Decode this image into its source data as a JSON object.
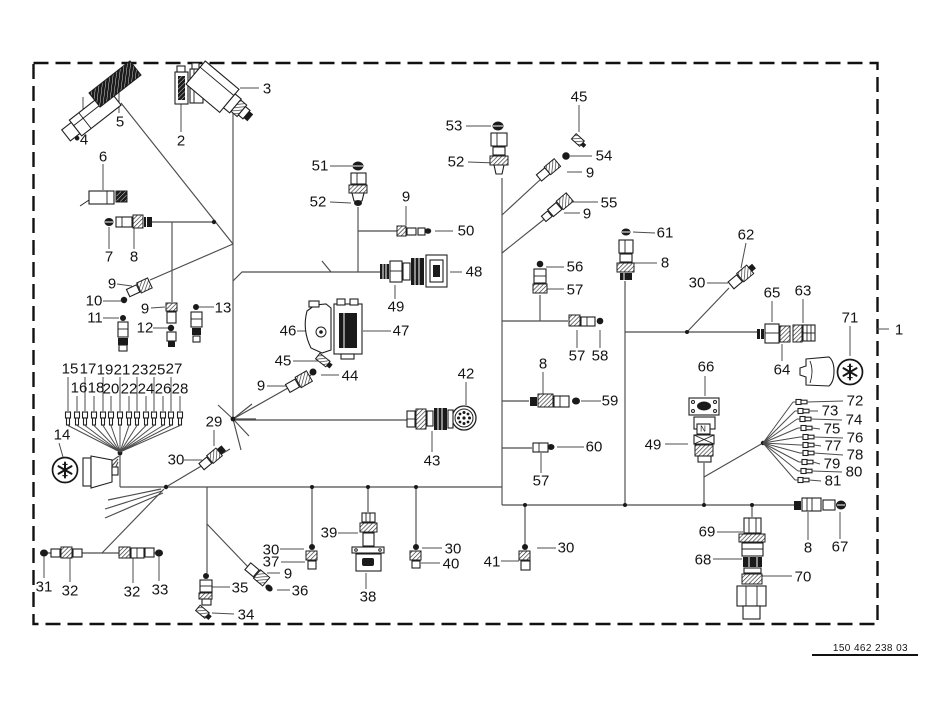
{
  "figure": {
    "drawing_number": "150 462 238 03",
    "frame_reference_label": "1"
  },
  "callouts": [
    {
      "t": "4",
      "x": 84,
      "y": 140
    },
    {
      "t": "5",
      "x": 120,
      "y": 122
    },
    {
      "t": "2",
      "x": 181,
      "y": 141
    },
    {
      "t": "3",
      "x": 267,
      "y": 89
    },
    {
      "t": "6",
      "x": 103,
      "y": 157
    },
    {
      "t": "7",
      "x": 109,
      "y": 257
    },
    {
      "t": "8",
      "x": 134,
      "y": 257
    },
    {
      "t": "9",
      "x": 112,
      "y": 284
    },
    {
      "t": "10",
      "x": 94,
      "y": 301
    },
    {
      "t": "11",
      "x": 95,
      "y": 318
    },
    {
      "t": "9",
      "x": 145,
      "y": 309
    },
    {
      "t": "12",
      "x": 145,
      "y": 328
    },
    {
      "t": "13",
      "x": 223,
      "y": 308
    },
    {
      "t": "51",
      "x": 320,
      "y": 166
    },
    {
      "t": "52",
      "x": 318,
      "y": 202
    },
    {
      "t": "9",
      "x": 406,
      "y": 197
    },
    {
      "t": "50",
      "x": 466,
      "y": 231
    },
    {
      "t": "53",
      "x": 454,
      "y": 126
    },
    {
      "t": "52",
      "x": 456,
      "y": 162
    },
    {
      "t": "45",
      "x": 579,
      "y": 97
    },
    {
      "t": "54",
      "x": 604,
      "y": 156
    },
    {
      "t": "9",
      "x": 590,
      "y": 173
    },
    {
      "t": "55",
      "x": 609,
      "y": 203
    },
    {
      "t": "9",
      "x": 587,
      "y": 214
    },
    {
      "t": "61",
      "x": 665,
      "y": 233
    },
    {
      "t": "8",
      "x": 665,
      "y": 263
    },
    {
      "t": "62",
      "x": 746,
      "y": 235
    },
    {
      "t": "30",
      "x": 697,
      "y": 283
    },
    {
      "t": "56",
      "x": 575,
      "y": 267
    },
    {
      "t": "57",
      "x": 575,
      "y": 290
    },
    {
      "t": "65",
      "x": 772,
      "y": 293
    },
    {
      "t": "63",
      "x": 803,
      "y": 291
    },
    {
      "t": "71",
      "x": 850,
      "y": 318
    },
    {
      "t": "64",
      "x": 782,
      "y": 370
    },
    {
      "t": "48",
      "x": 474,
      "y": 272
    },
    {
      "t": "49",
      "x": 396,
      "y": 307
    },
    {
      "t": "46",
      "x": 288,
      "y": 331
    },
    {
      "t": "47",
      "x": 401,
      "y": 331
    },
    {
      "t": "45",
      "x": 283,
      "y": 361
    },
    {
      "t": "44",
      "x": 350,
      "y": 376
    },
    {
      "t": "9",
      "x": 261,
      "y": 386
    },
    {
      "t": "42",
      "x": 466,
      "y": 374
    },
    {
      "t": "43",
      "x": 432,
      "y": 461
    },
    {
      "t": "57",
      "x": 577,
      "y": 356
    },
    {
      "t": "58",
      "x": 600,
      "y": 356
    },
    {
      "t": "8",
      "x": 543,
      "y": 364
    },
    {
      "t": "59",
      "x": 610,
      "y": 401
    },
    {
      "t": "60",
      "x": 594,
      "y": 447
    },
    {
      "t": "57",
      "x": 541,
      "y": 481
    },
    {
      "t": "66",
      "x": 706,
      "y": 367
    },
    {
      "t": "49",
      "x": 653,
      "y": 445
    },
    {
      "t": "72",
      "x": 855,
      "y": 401
    },
    {
      "t": "73",
      "x": 830,
      "y": 411
    },
    {
      "t": "74",
      "x": 854,
      "y": 420
    },
    {
      "t": "75",
      "x": 832,
      "y": 429
    },
    {
      "t": "76",
      "x": 855,
      "y": 438
    },
    {
      "t": "77",
      "x": 833,
      "y": 446
    },
    {
      "t": "78",
      "x": 855,
      "y": 455
    },
    {
      "t": "79",
      "x": 832,
      "y": 464
    },
    {
      "t": "80",
      "x": 854,
      "y": 472
    },
    {
      "t": "81",
      "x": 833,
      "y": 481
    },
    {
      "t": "1",
      "x": 899,
      "y": 330
    },
    {
      "t": "15",
      "x": 70,
      "y": 369
    },
    {
      "t": "17",
      "x": 88,
      "y": 369
    },
    {
      "t": "19",
      "x": 105,
      "y": 370
    },
    {
      "t": "21",
      "x": 122,
      "y": 370
    },
    {
      "t": "23",
      "x": 140,
      "y": 370
    },
    {
      "t": "25",
      "x": 157,
      "y": 370
    },
    {
      "t": "27",
      "x": 174,
      "y": 369
    },
    {
      "t": "16",
      "x": 79,
      "y": 388
    },
    {
      "t": "18",
      "x": 96,
      "y": 388
    },
    {
      "t": "20",
      "x": 111,
      "y": 389
    },
    {
      "t": "22",
      "x": 129,
      "y": 389
    },
    {
      "t": "24",
      "x": 146,
      "y": 389
    },
    {
      "t": "26",
      "x": 163,
      "y": 389
    },
    {
      "t": "28",
      "x": 180,
      "y": 389
    },
    {
      "t": "14",
      "x": 62,
      "y": 435
    },
    {
      "t": "29",
      "x": 214,
      "y": 422
    },
    {
      "t": "30",
      "x": 176,
      "y": 460
    },
    {
      "t": "31",
      "x": 44,
      "y": 587
    },
    {
      "t": "32",
      "x": 70,
      "y": 591
    },
    {
      "t": "32",
      "x": 132,
      "y": 592
    },
    {
      "t": "33",
      "x": 160,
      "y": 590
    },
    {
      "t": "35",
      "x": 240,
      "y": 588
    },
    {
      "t": "34",
      "x": 246,
      "y": 615
    },
    {
      "t": "9",
      "x": 288,
      "y": 574
    },
    {
      "t": "36",
      "x": 300,
      "y": 591
    },
    {
      "t": "30",
      "x": 271,
      "y": 550
    },
    {
      "t": "37",
      "x": 271,
      "y": 562
    },
    {
      "t": "39",
      "x": 329,
      "y": 533
    },
    {
      "t": "38",
      "x": 368,
      "y": 597
    },
    {
      "t": "30",
      "x": 453,
      "y": 549
    },
    {
      "t": "40",
      "x": 451,
      "y": 564
    },
    {
      "t": "30",
      "x": 566,
      "y": 548
    },
    {
      "t": "41",
      "x": 492,
      "y": 562
    },
    {
      "t": "69",
      "x": 707,
      "y": 532
    },
    {
      "t": "68",
      "x": 703,
      "y": 560
    },
    {
      "t": "70",
      "x": 803,
      "y": 577
    },
    {
      "t": "8",
      "x": 808,
      "y": 548
    },
    {
      "t": "67",
      "x": 840,
      "y": 547
    },
    {
      "t": "N",
      "x": 703,
      "y": 429,
      "s": true
    }
  ]
}
